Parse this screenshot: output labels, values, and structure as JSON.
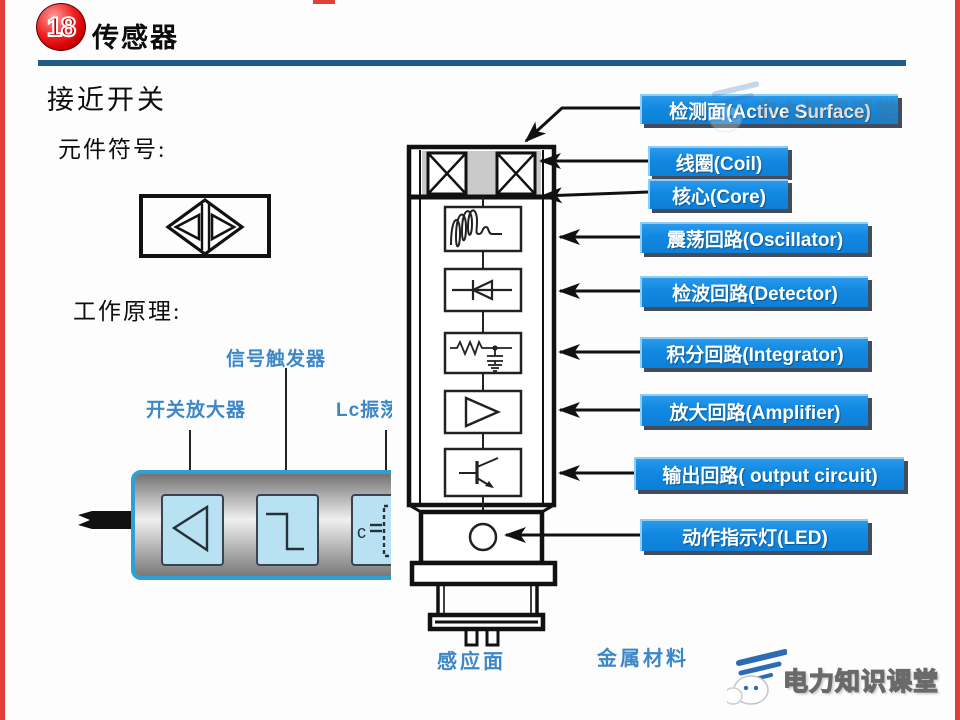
{
  "header": {
    "badge": "18",
    "title": "传感器"
  },
  "headings": {
    "page": "接近开关",
    "symbol": "元件符号:",
    "principle": "工作原理:"
  },
  "left_diagram": {
    "trigger": "信号触发器",
    "amplifier": "开关放大器",
    "oscillator": "Lc振荡"
  },
  "callouts": {
    "active_surface": "检测面(Active Surface)",
    "coil": "线圈(Coil)",
    "core": "核心(Core)",
    "oscillator": "震荡回路(Oscillator)",
    "detector": "检波回路(Detector)",
    "integrator": "积分回路(Integrator)",
    "amplifier": "放大回路(Amplifier)",
    "output": "输出回路( output circuit)",
    "led": "动作指示灯(LED)"
  },
  "bottom_labels": {
    "sensing_surface": "感应面",
    "metal": "金属材料"
  },
  "watermark": {
    "text": "电力知识课堂"
  },
  "colors": {
    "label_blue": "#1289e2",
    "label_blue_dark": "#0d7fd6",
    "line_blue": "#1f5c8b",
    "diagram_blue": "#3c87c8",
    "badge_red": "#d40000",
    "edge_red": "#e04038"
  }
}
